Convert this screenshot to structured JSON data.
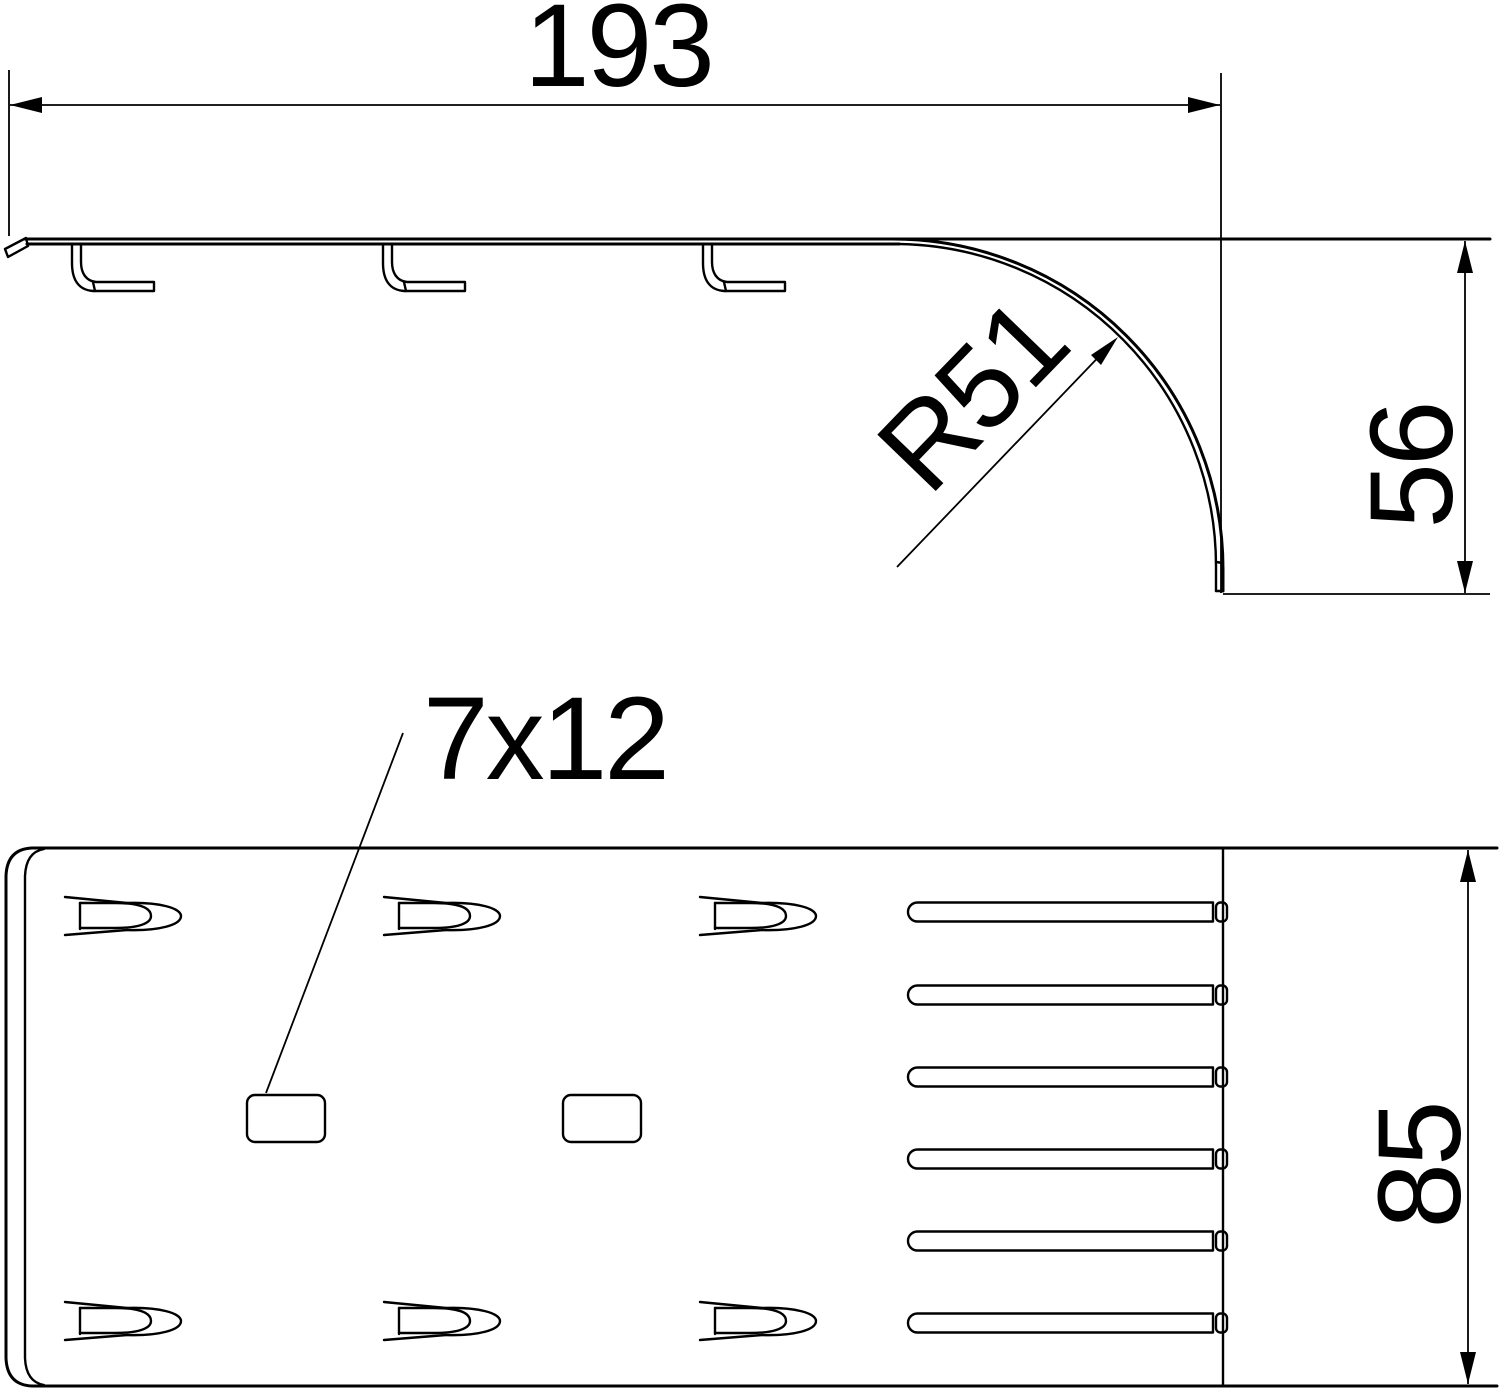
{
  "drawing": {
    "background": "#ffffff",
    "line_color": "#000000",
    "views": {
      "side": {
        "dims": {
          "length": "193",
          "radius": "R51",
          "height": "56"
        }
      },
      "plan": {
        "dims": {
          "slot_size": "7x12",
          "width": "85"
        }
      }
    }
  }
}
